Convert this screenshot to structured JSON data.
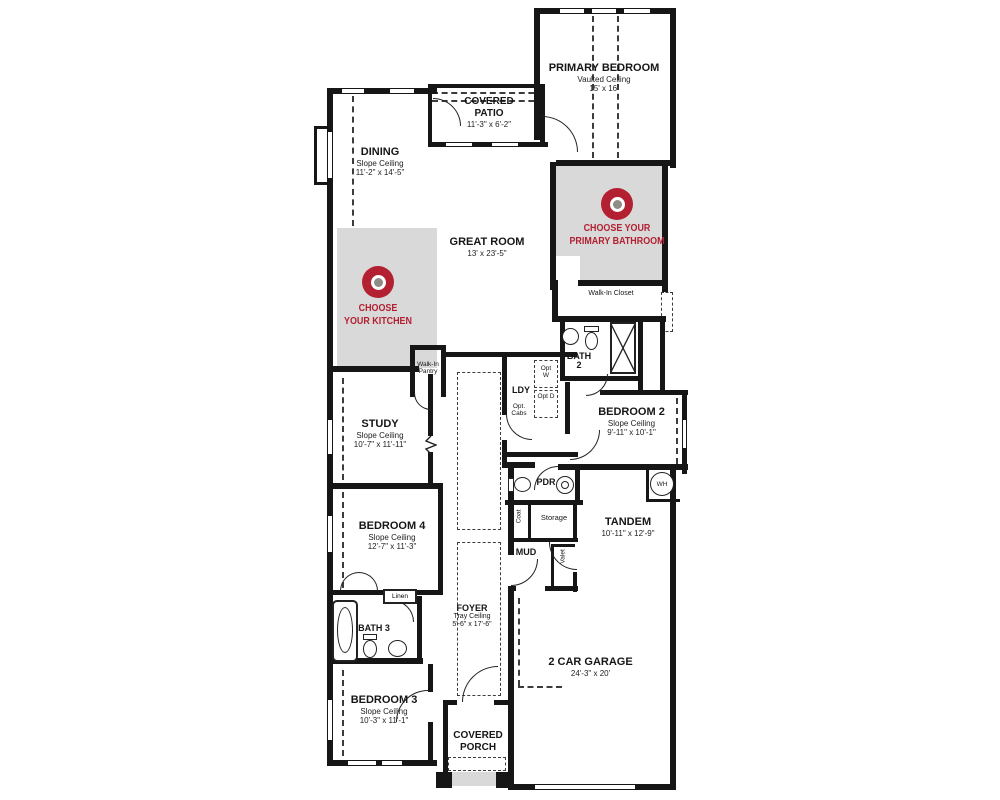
{
  "plan": {
    "rooms": {
      "primary_bedroom": {
        "name": "PRIMARY BEDROOM",
        "ceiling": "Vaulted Ceiling",
        "dims": "15' x 16'"
      },
      "covered_patio": {
        "name": "COVERED PATIO",
        "dims": "11'-3\" x 6'-2\""
      },
      "dining": {
        "name": "DINING",
        "ceiling": "Slope Ceiling",
        "dims": "11'-2\" x 14'-5\""
      },
      "great_room": {
        "name": "GREAT ROOM",
        "dims": "13' x 23'-5\""
      },
      "walk_in_closet": {
        "name": "Walk-In Closet"
      },
      "bath_2": {
        "name": "BATH 2"
      },
      "laundry": {
        "name": "LDY"
      },
      "bedroom_2": {
        "name": "BEDROOM 2",
        "ceiling": "Slope Ceiling",
        "dims": "9'-11\" x 10'-1\""
      },
      "study": {
        "name": "STUDY",
        "ceiling": "Slope Ceiling",
        "dims": "10'-7\" x 11'-11\""
      },
      "walk_in_pantry": {
        "name": "Walk-In Pantry"
      },
      "powder": {
        "name": "PDR"
      },
      "water_heater": {
        "name": "WH"
      },
      "storage": {
        "name": "Storage"
      },
      "coat": {
        "name": "Coat"
      },
      "mud": {
        "name": "MUD"
      },
      "valet": {
        "name": "Valet"
      },
      "tandem": {
        "name": "TANDEM",
        "dims": "10'-11\" x 12'-9\""
      },
      "bedroom_4": {
        "name": "BEDROOM 4",
        "ceiling": "Slope Ceiling",
        "dims": "12'-7\" x 11'-3\""
      },
      "linen": {
        "name": "Linen"
      },
      "bath_3": {
        "name": "BATH 3"
      },
      "foyer": {
        "name": "FOYER",
        "ceiling": "Tray Ceiling",
        "dims": "5'-6\" x 17'-6\""
      },
      "bedroom_3": {
        "name": "BEDROOM 3",
        "ceiling": "Slope Ceiling",
        "dims": "10'-3\" x 11'-1\""
      },
      "covered_porch": {
        "name": "COVERED PORCH"
      },
      "garage": {
        "name": "2 CAR GARAGE",
        "dims": "24'-3\" x 20'"
      }
    },
    "options": {
      "opt_washer": "Opt W",
      "opt_dryer": "Opt D",
      "opt_cabs": "Opt. Cabs"
    },
    "markers": {
      "kitchen": {
        "line1": "CHOOSE",
        "line2": "YOUR KITCHEN"
      },
      "primary_bathroom": {
        "line1": "CHOOSE YOUR",
        "line2": "PRIMARY BATHROOM"
      }
    },
    "colors": {
      "accent_red": "#b32031",
      "zone_gray": "#d9d9d9",
      "wall_black": "#161616",
      "marker_dot_gray": "#8d8d85"
    }
  }
}
